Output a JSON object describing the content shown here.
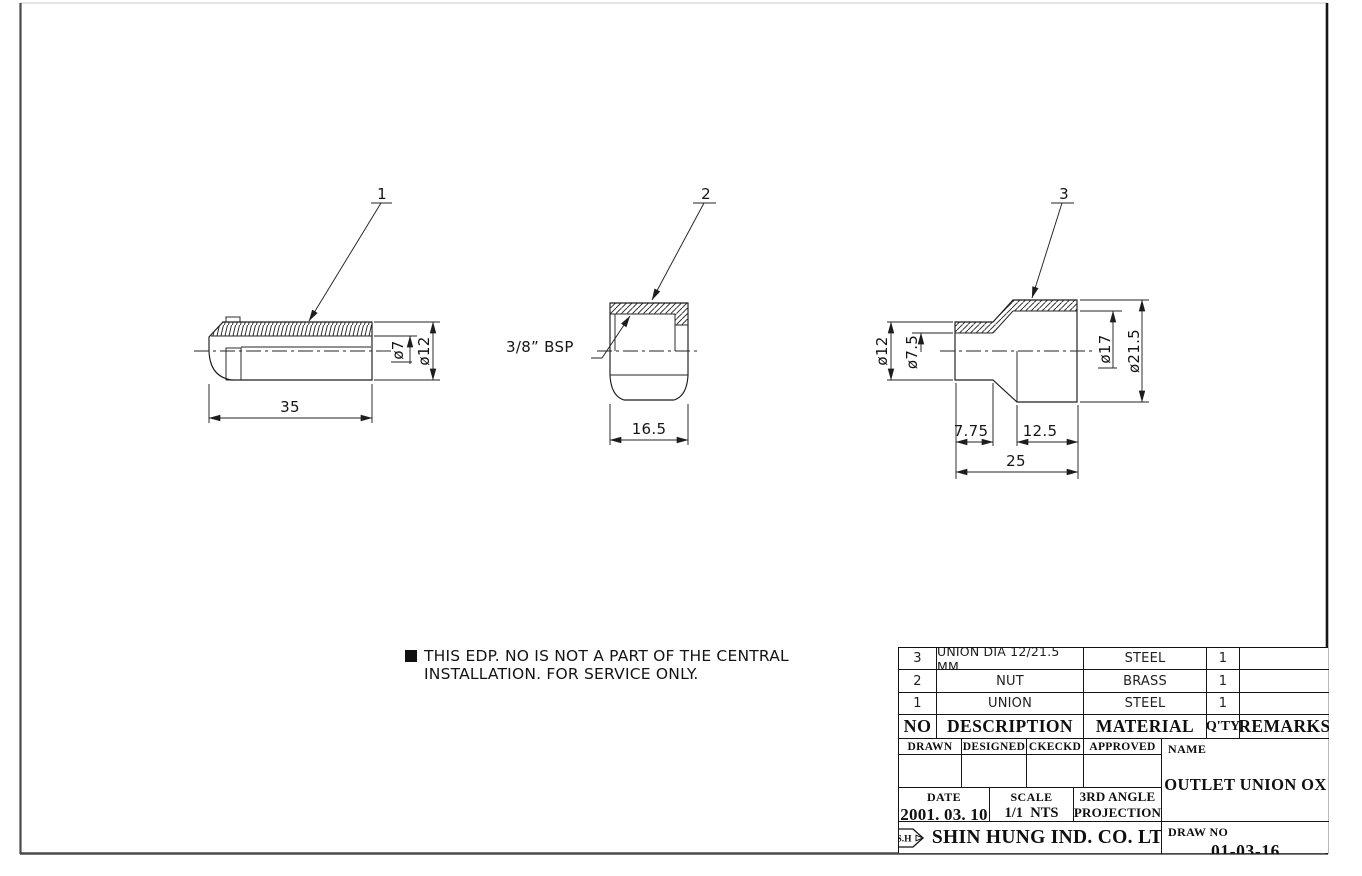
{
  "colors": {
    "line": "#1d1d1d",
    "frame_side": "#4a4a4a",
    "frame_right": "#161616"
  },
  "note": {
    "line1": "THIS EDP. NO IS NOT A PART OF THE CENTRAL",
    "line2": "INSTALLATION. FOR SERVICE ONLY."
  },
  "views": [
    {
      "balloon": "1",
      "dims": {
        "length": "35",
        "bore": "ø7",
        "od": "ø12"
      }
    },
    {
      "balloon": "2",
      "thread": "3/8” BSP",
      "dims": {
        "width": "16.5"
      }
    },
    {
      "balloon": "3",
      "dims": {
        "od_small": "ø12",
        "bore_small": "ø7.5",
        "bore_large": "ø17",
        "od_large": "ø21.5",
        "len_small": "7.75",
        "len_large": "12.5",
        "len_total": "25"
      }
    }
  ],
  "parts_table": {
    "headers": {
      "no": "NO",
      "description": "DESCRIPTION",
      "material": "MATERIAL",
      "qty": "Q'TY",
      "remarks": "REMARKS"
    },
    "rows": [
      {
        "no": "3",
        "description": "UNION DIA 12/21.5 MM",
        "material": "STEEL",
        "qty": "1",
        "remarks": ""
      },
      {
        "no": "2",
        "description": "NUT",
        "material": "BRASS",
        "qty": "1",
        "remarks": ""
      },
      {
        "no": "1",
        "description": "UNION",
        "material": "STEEL",
        "qty": "1",
        "remarks": ""
      }
    ]
  },
  "title_block": {
    "sign_headers": {
      "drawn": "DRAWN",
      "designed": "DESIGNED",
      "checked": "CKECKD",
      "approved": "APPROVED"
    },
    "name_label": "NAME",
    "name_value": "OUTLET UNION OX",
    "date_label": "DATE",
    "date_value": "2001. 03. 10",
    "scale_label": "SCALE",
    "scale_value": "1/1  NTS",
    "projection_line1": "3RD ANGLE",
    "projection_line2": "PROJECTION",
    "company": "SHIN HUNG IND. CO. LTD",
    "logo_text": "S.H",
    "drawno_label": "DRAW NO",
    "drawno_value": "01-03-16"
  }
}
